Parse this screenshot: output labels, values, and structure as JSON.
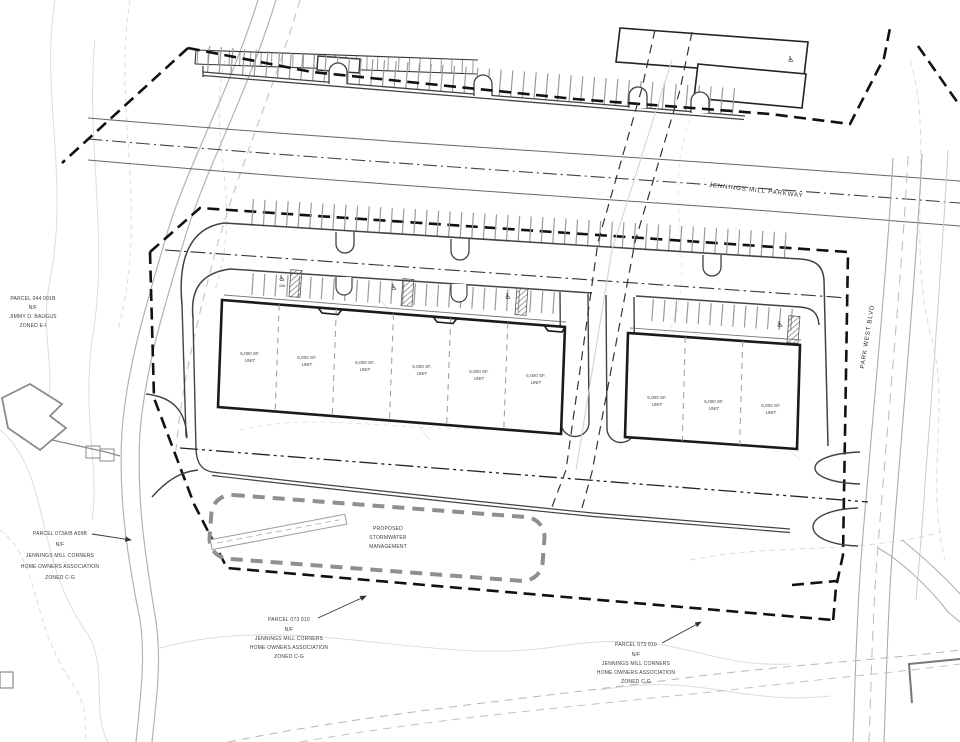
{
  "sheet": {
    "title": "site plan"
  },
  "roads": {
    "parkway_label": "JENNINGS MILL PARKWAY",
    "blvd_label": "PARK WEST BLVD"
  },
  "parcels": {
    "baugus": [
      "PARCEL 044 001B",
      "N/F",
      "JIMMY D. BAUGUS",
      "ZONED E-I"
    ],
    "hoa_west": [
      "PARCEL 073A/B A09B",
      "N/F",
      "JENNINGS MILL CORNERS",
      "HOME OWNERS ASSOCIATION",
      "ZONED C-G"
    ],
    "hoa_south": [
      "PARCEL 073 010",
      "N/F",
      "JENNINGS MILL CORNERS",
      "HOME OWNERS ASSOCIATION",
      "ZONED C-G"
    ],
    "hoa_southeast": [
      "PARCEL 073 010",
      "N/F",
      "JENNINGS MILL CORNERS",
      "HOME OWNERS ASSOCIATION",
      "ZONED C-G"
    ]
  },
  "stormwater": {
    "lines": [
      "PROPOSED",
      "STORMWATER",
      "MANAGEMENT"
    ]
  },
  "unit_label": {
    "line1": "5,000 SF.",
    "line2": "UNIT"
  },
  "buildings": {
    "left_unit_count": 6,
    "right_unit_count": 3
  },
  "icons": {
    "accessible_parking_symbol": "♿"
  },
  "accessibility": {
    "van_label": "VAN"
  },
  "colors": {
    "paper": "#ffffff",
    "building_line": "#1a1a1a",
    "boundary_dash": "#111111",
    "pond_dash": "#8f8f8f",
    "curb": "#424242",
    "contour": "#d9d9d9",
    "road_gray": "#aaaaaa"
  }
}
